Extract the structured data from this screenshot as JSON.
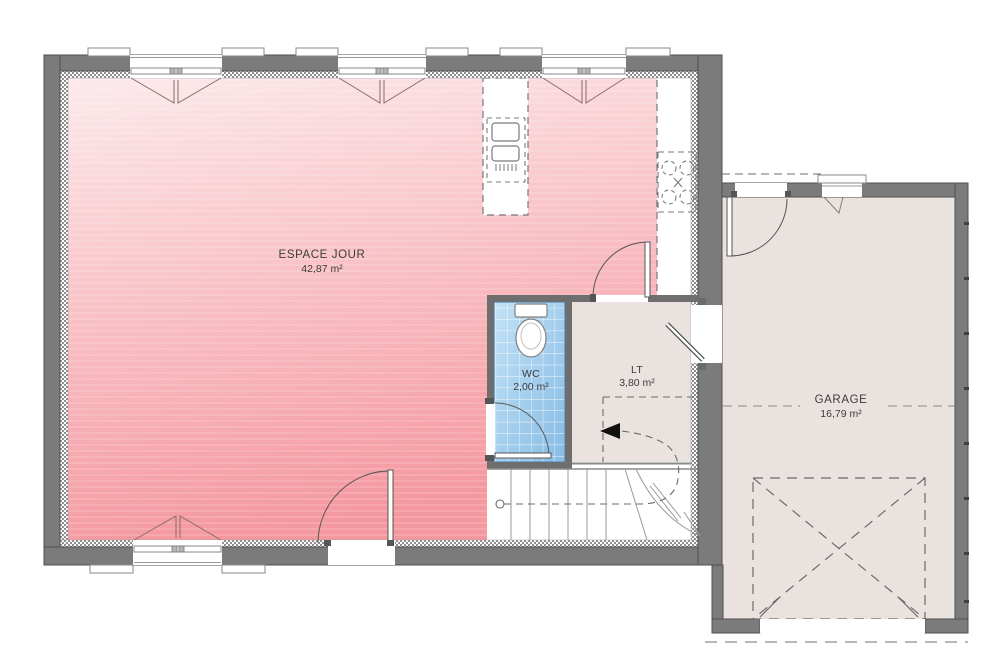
{
  "plan": {
    "title": "floor-plan-ground-level",
    "rooms": {
      "espace_jour": {
        "name": "ESPACE JOUR",
        "area": "42,87 m²"
      },
      "wc": {
        "name": "WC",
        "area": "2,00 m²"
      },
      "lt": {
        "name": "LT",
        "area": "3,80 m²"
      },
      "garage": {
        "name": "GARAGE",
        "area": "16,79 m²"
      }
    },
    "colors": {
      "wall_gray": "#7b7b7b",
      "wall_outline": "#4f4f4f",
      "pink_light": "#fceaec",
      "pink_dark": "#f4989f",
      "tile_blue_light": "#c3e2f7",
      "tile_blue_dark": "#86bce4",
      "floor_beige": "#eae2de",
      "symbol_line": "#555555",
      "text": "#3c3c3c"
    }
  }
}
